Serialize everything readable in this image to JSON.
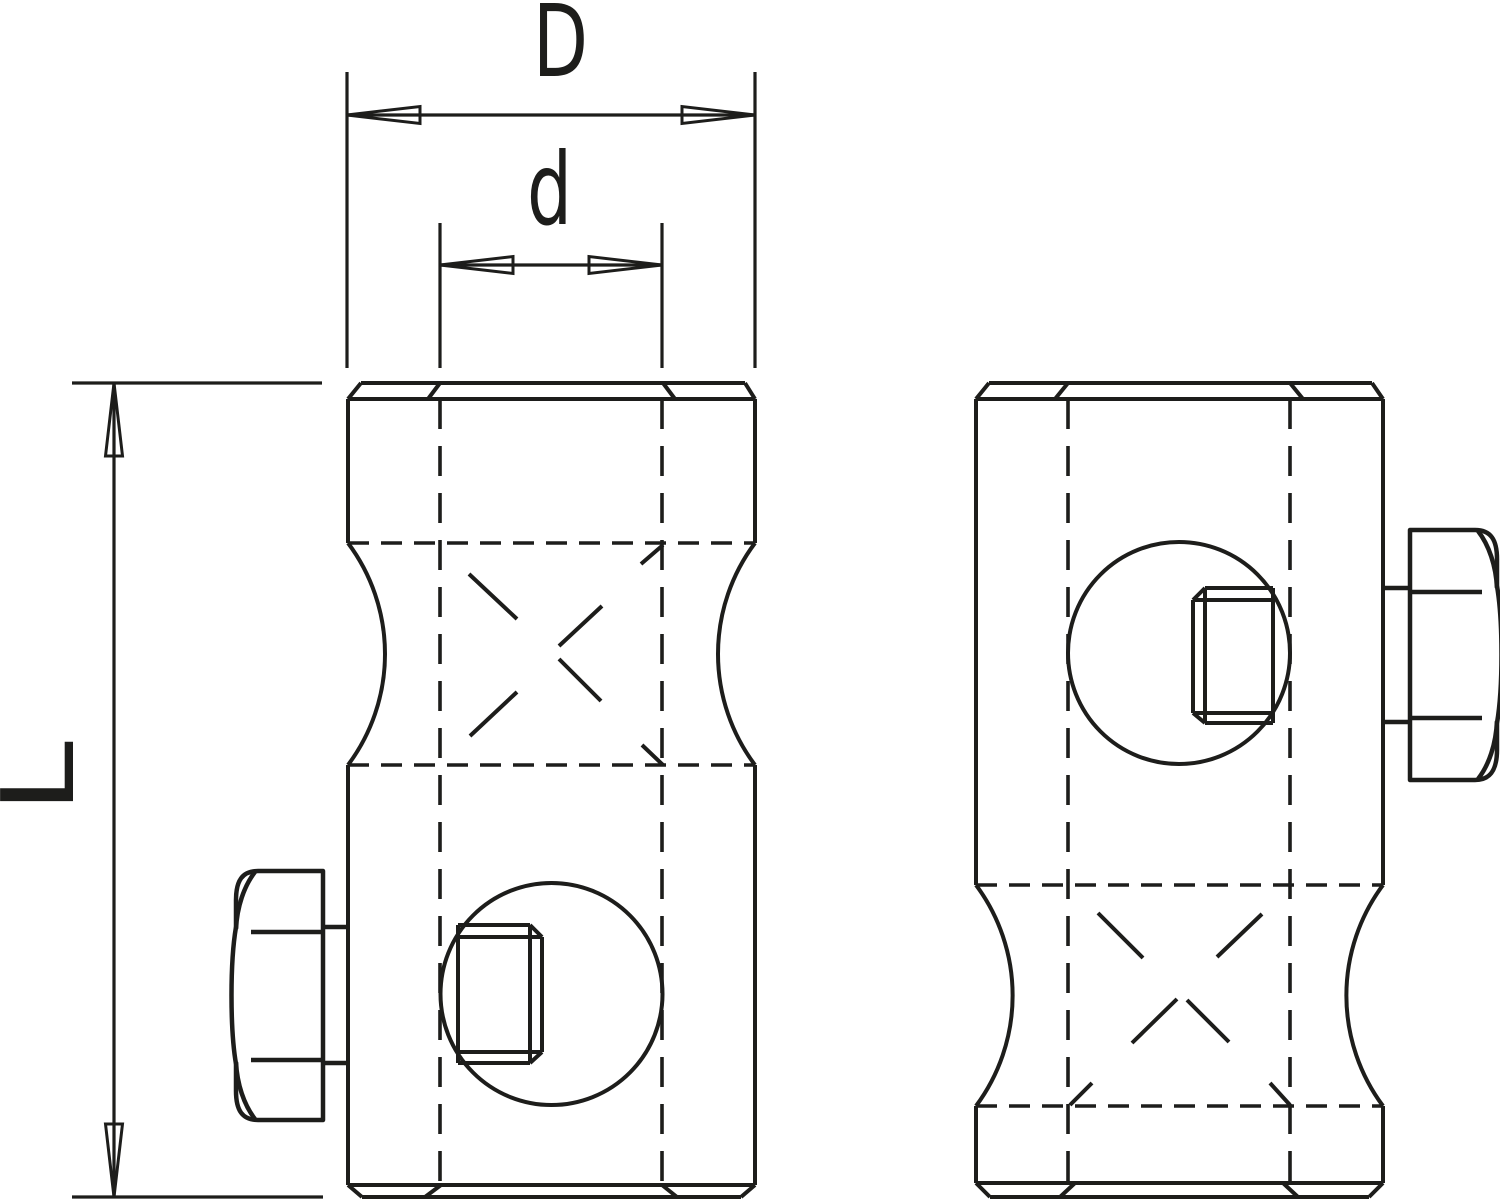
{
  "drawing": {
    "description": "Two-view technical line drawing of a cylindrical cross clamp with waisted neck, hidden bore lines and hex-head set screws",
    "colors": {
      "line": "#1d1d1b",
      "background": "#ffffff"
    },
    "labels": {
      "outer_diameter": "D",
      "bore_diameter": "d",
      "length": "L"
    }
  }
}
